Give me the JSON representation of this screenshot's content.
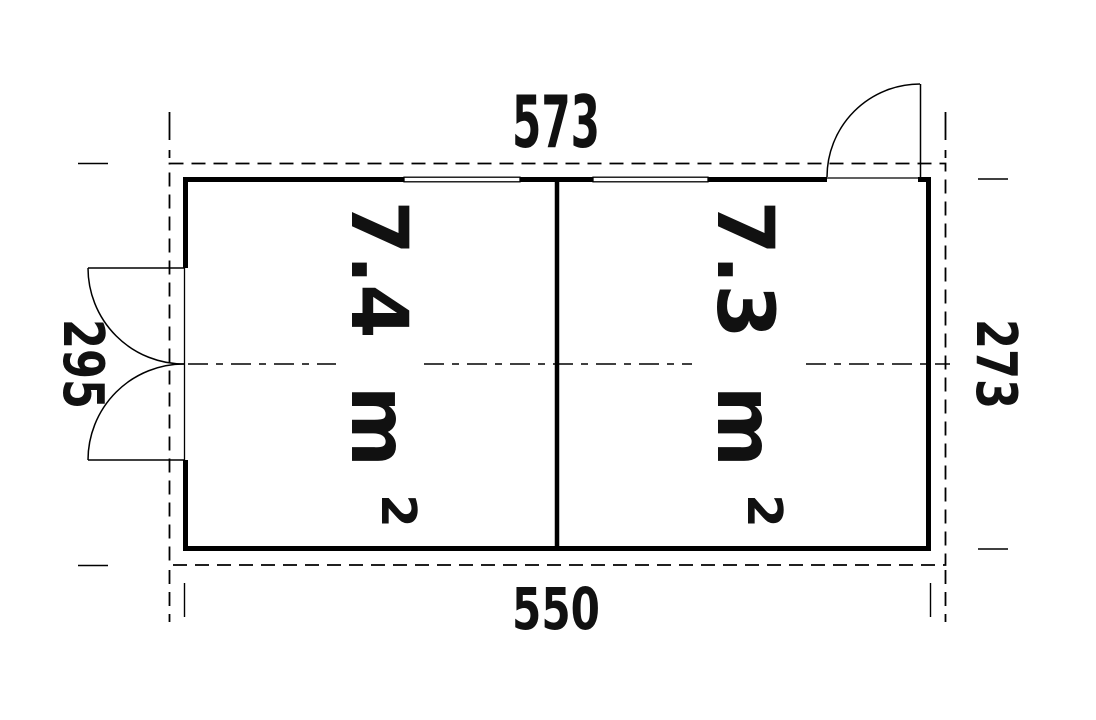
{
  "drawing": {
    "kind": "floor-plan",
    "dimensions": {
      "top": "573",
      "bottom": "550",
      "left": "295",
      "right": "273"
    },
    "rooms": [
      {
        "area": "7.4",
        "unit": "m",
        "sup": "2"
      },
      {
        "area": "7.3",
        "unit": "m",
        "sup": "2"
      }
    ],
    "colors": {
      "line": "#000000",
      "background": "#ffffff"
    }
  }
}
